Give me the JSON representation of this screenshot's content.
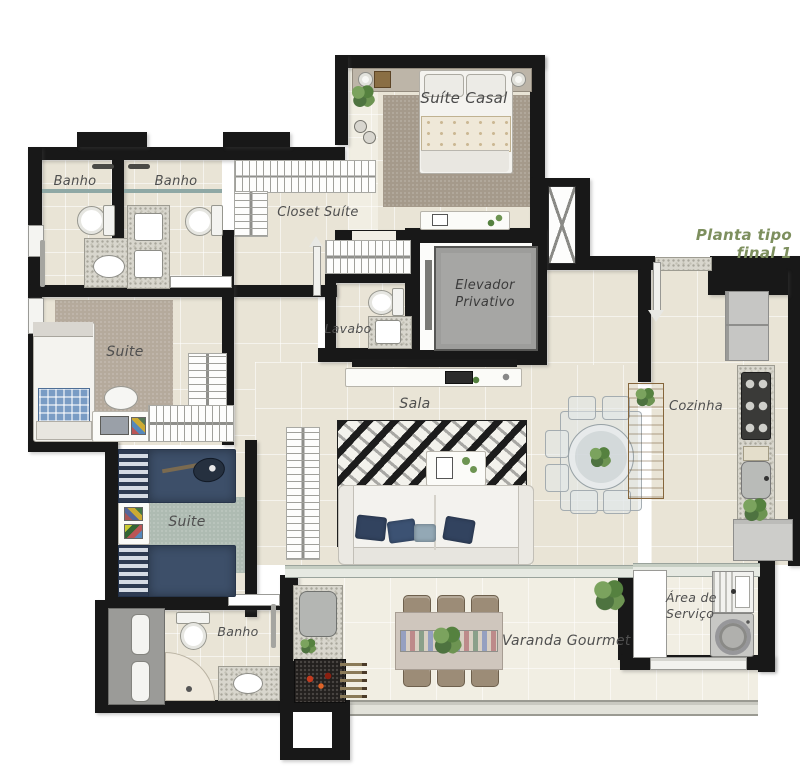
{
  "title": {
    "text": "Planta tipo final 1",
    "color": "#7d8f5e"
  },
  "rooms": {
    "banho_top_left": "Banho",
    "banho_top_middle": "Banho",
    "closet_suite": "Closet Suíte",
    "suite_casal": "Suíte Casal",
    "lavabo": "Lavabo",
    "elevador_line1": "Elevador",
    "elevador_line2": "Privativo",
    "suite_left": "Suite",
    "suite_lower_left": "Suite",
    "sala": "Sala",
    "cozinha": "Cozinha",
    "banho_lower": "Banho",
    "varanda_gourmet": "Varanda Gourmet",
    "area_servico_line1": "Área de",
    "area_servico_line2": "Serviço"
  },
  "palette": {
    "wall": "#181818",
    "floor": "#e9e4d6",
    "floor_light": "#f1eee3",
    "rug_taupe": "#a59a8b",
    "rug_sage": "#aebbb2",
    "bed_navy": "#3d4f69",
    "wood": "#b08a55",
    "granite": "#d8d6cd",
    "glass_teal": "#8fa8a5",
    "title_green": "#7d8f5e"
  }
}
